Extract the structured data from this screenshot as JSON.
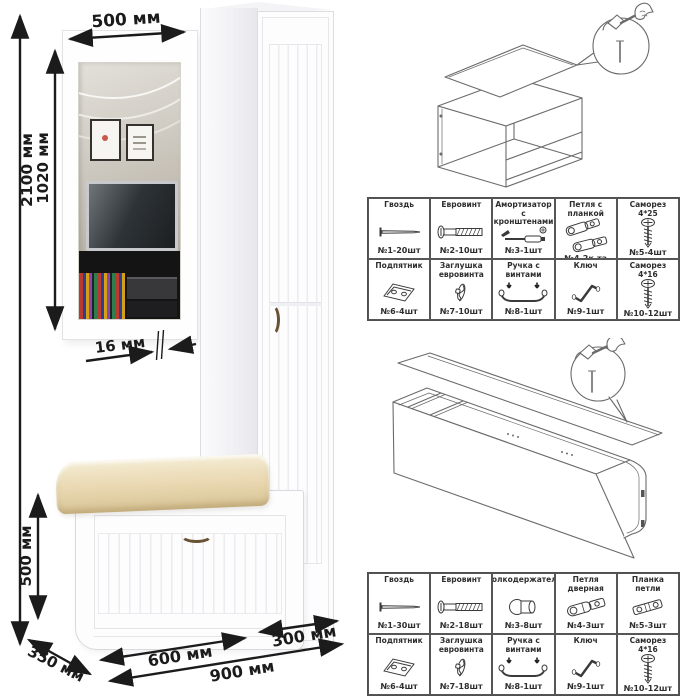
{
  "dimension_labels": {
    "mirror_width": "500 мм",
    "total_height": "2100 мм",
    "mirror_height": "1020 мм",
    "mirror_thickness": "16 мм",
    "bench_height": "500 мм",
    "bench_depth": "350 мм",
    "bench_width": "600 мм",
    "cabinet_width": "300 мм",
    "total_width": "900 мм"
  },
  "assembly": {
    "tool_icon": "hammer-and-nail-icon"
  },
  "hardware_tables": [
    {
      "name": "bench-and-mirror-hardware",
      "rows": [
        [
          {
            "label": "Гвоздь",
            "qty": "№1-20шт",
            "icon": "nail-icon"
          },
          {
            "label": "Евровинт",
            "qty": "№2-10шт",
            "icon": "euro-screw-icon"
          },
          {
            "label": "Амортизатор с кронштенами",
            "qty": "№3-1шт",
            "icon": "gas-lift-icon"
          },
          {
            "label": "Петля с планкой",
            "qty": "№4-2к-та",
            "icon": "hinge-with-plate-icon"
          },
          {
            "label": "Саморез 4*25",
            "qty": "№5-4шт",
            "icon": "screw-icon"
          }
        ],
        [
          {
            "label": "Подпятник",
            "qty": "№6-4шт",
            "icon": "foot-plate-icon"
          },
          {
            "label": "Заглушка евровинта",
            "qty": "№7-10шт",
            "icon": "screw-cap-icon"
          },
          {
            "label": "Ручка с винтами",
            "qty": "№8-1шт",
            "icon": "handle-icon"
          },
          {
            "label": "Ключ",
            "qty": "№9-1шт",
            "icon": "hex-key-icon"
          },
          {
            "label": "Саморез 4*16",
            "qty": "№10-12шт",
            "icon": "screw-icon"
          }
        ]
      ]
    },
    {
      "name": "cabinet-hardware",
      "rows": [
        [
          {
            "label": "Гвоздь",
            "qty": "№1-30шт",
            "icon": "nail-icon"
          },
          {
            "label": "Евровинт",
            "qty": "№2-18шт",
            "icon": "euro-screw-icon"
          },
          {
            "label": "Полкодержатель",
            "qty": "№3-8шт",
            "icon": "shelf-pin-icon"
          },
          {
            "label": "Петля дверная",
            "qty": "№4-3шт",
            "icon": "hinge-icon"
          },
          {
            "label": "Планка петли",
            "qty": "№5-3шт",
            "icon": "hinge-plate-icon"
          }
        ],
        [
          {
            "label": "Подпятник",
            "qty": "№6-4шт",
            "icon": "foot-plate-icon"
          },
          {
            "label": "Заглушка евровинта",
            "qty": "№7-18шт",
            "icon": "screw-cap-icon"
          },
          {
            "label": "Ручка с винтами",
            "qty": "№8-1шт",
            "icon": "handle-icon"
          },
          {
            "label": "Ключ",
            "qty": "№9-1шт",
            "icon": "hex-key-icon"
          },
          {
            "label": "Саморез 4*16",
            "qty": "№10-12шт",
            "icon": "screw-icon"
          }
        ]
      ]
    }
  ],
  "colors": {
    "cushion": "#ead9b3",
    "handle_bronze": "#6a5234",
    "dimension_line": "#1b1b1b",
    "table_border": "#4f4f4f"
  }
}
